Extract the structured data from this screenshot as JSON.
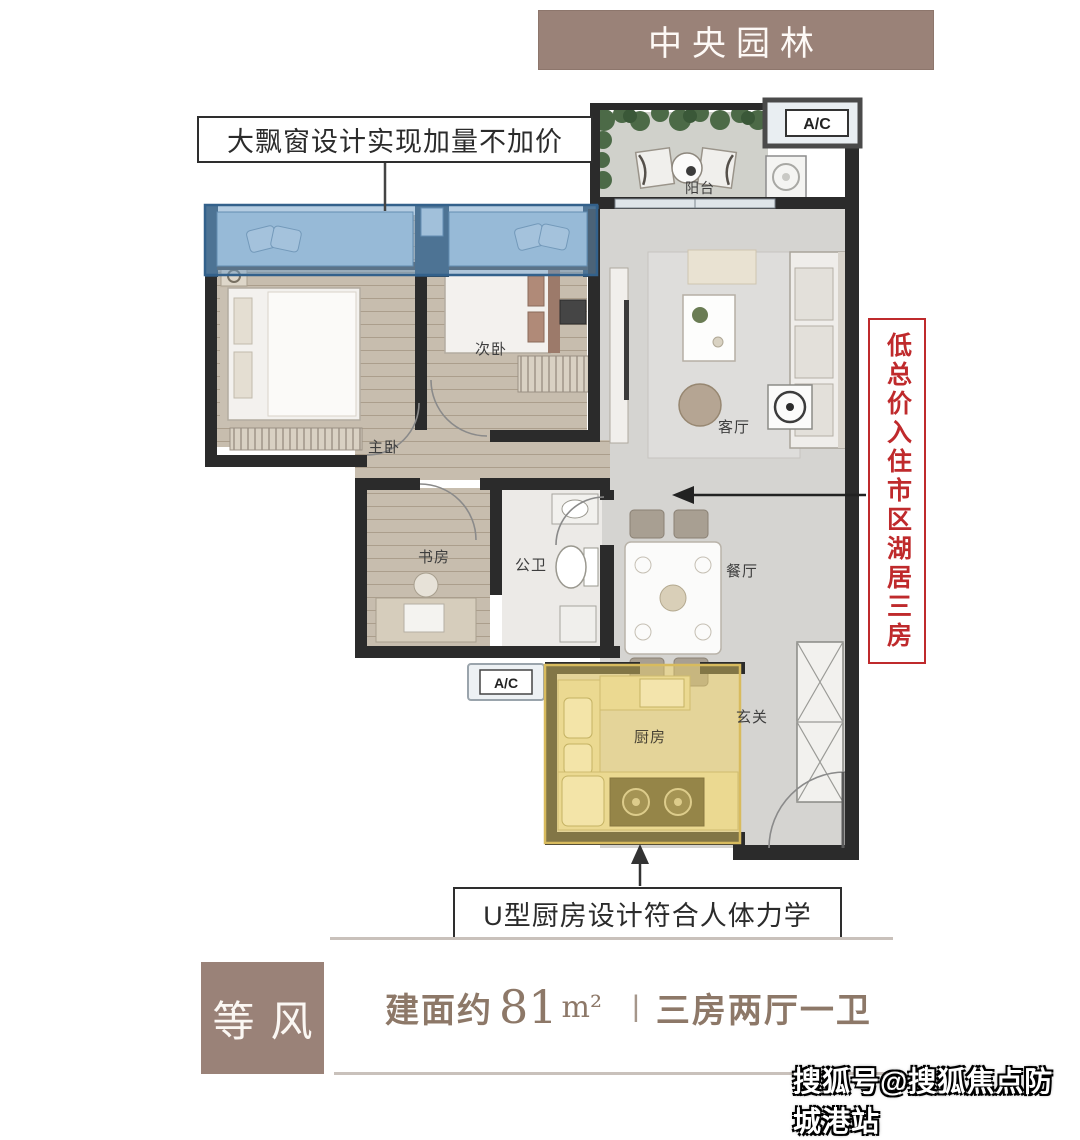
{
  "banner": {
    "title": "中央园林"
  },
  "callouts": {
    "bay_window": {
      "text": "大飘窗设计实现加量不加价"
    },
    "value_vertical": {
      "text": "低总价入住市区湖居三房"
    },
    "kitchen": {
      "text": "U型厨房设计符合人体力学"
    }
  },
  "floor_plan": {
    "rooms": {
      "balcony": "阳台",
      "second_bedroom": "次卧",
      "master_bedroom": "主卧",
      "study": "书房",
      "bathroom": "公卫",
      "living_room": "客厅",
      "dining_room": "餐厅",
      "kitchen": "厨房",
      "entry": "玄关"
    },
    "labels": {
      "ac_top": "A/C",
      "ac_side": "A/C"
    }
  },
  "footer": {
    "unit_name": "等风",
    "area_prefix": "建面约",
    "area_value": "81",
    "area_unit": "m²",
    "divider": "|",
    "layout_text": "三房两厅一卫"
  },
  "watermark": {
    "text": "搜狐号@搜狐焦点防城港站"
  },
  "colors": {
    "taupe": "#9a8278",
    "red": "#bf2a2c",
    "blue_overlay": "#6c9cc6",
    "yellow_overlay": "#edd269",
    "wall": "#2b2b2b"
  }
}
